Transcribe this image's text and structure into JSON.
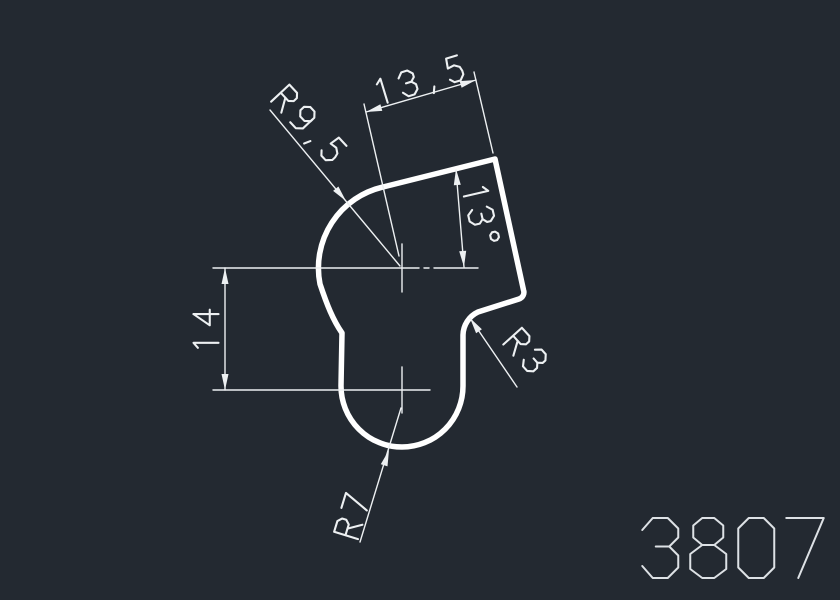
{
  "drawing": {
    "title": "profile-cross-section",
    "part_number": "3807",
    "dimensions": {
      "width": "13,5",
      "radius_top": "R9,5",
      "angle": "13°",
      "height": "14",
      "radius_notch": "R3",
      "radius_bottom": "R7"
    },
    "colors": {
      "background": "#232931",
      "profile_line": "#ffffff",
      "dimension_line": "#edf0f2",
      "part_number_text": "#dde1e5"
    }
  }
}
